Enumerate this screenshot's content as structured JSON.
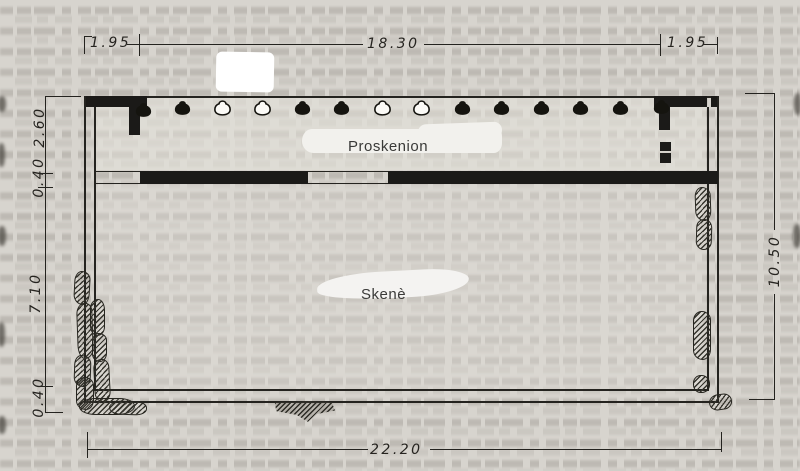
{
  "figure": {
    "labels": {
      "proskenion": "Proskenion",
      "skene": "Skenè"
    },
    "dimensions": {
      "top_left": "1.95",
      "top_center": "18.30",
      "top_right": "1.95",
      "left_top": "2.60",
      "left_upper_wall": "0.40",
      "left_middle": "7.10",
      "left_bottom_wall": "0.40",
      "right_total": "10.50",
      "bottom_total": "22.20"
    },
    "columns": {
      "total": 14,
      "pattern_left_to_right": [
        "engaged-filled",
        "filled",
        "open",
        "open",
        "filled",
        "filled",
        "open",
        "open",
        "filled",
        "filled",
        "filled",
        "filled",
        "filled",
        "engaged-filled"
      ]
    },
    "colors": {
      "paper": "#d7d4ce",
      "ink": "#1b1a18",
      "whiteout": "#ffffff"
    }
  }
}
